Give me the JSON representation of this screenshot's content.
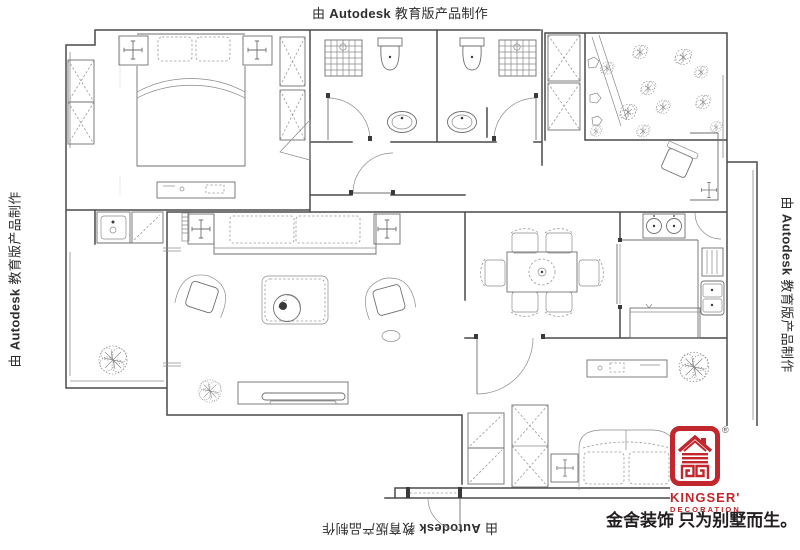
{
  "watermark": {
    "prefix": "由",
    "brand": "Autodesk",
    "suffix": "教育版产品制作"
  },
  "branding": {
    "registered": "®",
    "name": "KINGSER'",
    "subtitle": "DECORATION",
    "slogan": "金舍装饰 只为别墅而生。",
    "brand_color": "#c1272d",
    "slogan_color": "#231f20"
  },
  "drawing": {
    "background": "#ffffff",
    "wall_color": "#4a4a4a",
    "furniture_line_color": "#6e6e6e",
    "soft_line_color": "#9a9a9a"
  }
}
